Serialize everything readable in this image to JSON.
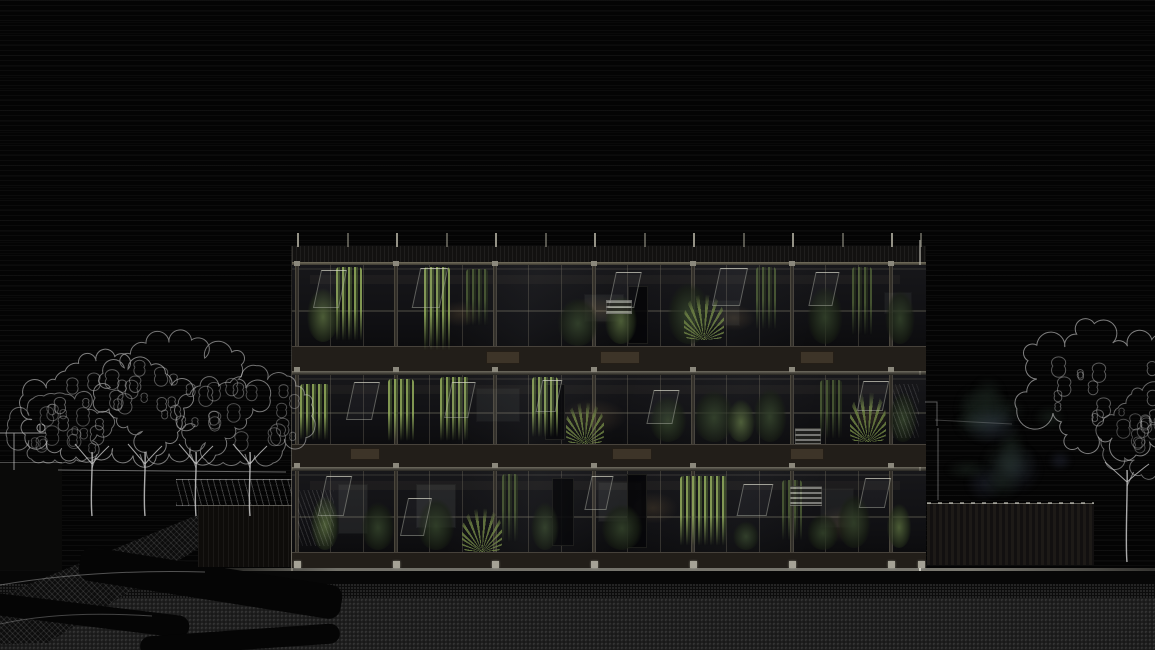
{
  "scene": {
    "type": "architectural-elevation-night-render",
    "description": "dark night elevation of a 3-storey glass building filled with plants, wireframe trees left and right, hatched ramp and stippled ground",
    "palette": {
      "sky": "#040404",
      "scanline": "rgba(255,255,255,0.03)",
      "frame_bright": "#a5a296",
      "frame_dark": "#26231e",
      "spandrel": "#221e19",
      "glass": "#141418",
      "vine_bright": "#8faa5c",
      "vine_mid": "#647c42",
      "foliage_dark": "#303e28",
      "foliage_mid": "#526439",
      "warm_light": "#b99258",
      "wireframe": "#c9c9c9",
      "fence": "#1b1816",
      "curb": "#969488",
      "ground": "#191919"
    },
    "building": {
      "floors": 3,
      "bay_columns_x": [
        297,
        396,
        495,
        594,
        693,
        792,
        891
      ],
      "parapet_post_count": 14,
      "floor_bands": [
        {
          "glass_top": 34,
          "glass_h": 81,
          "spandrel_top": 115,
          "spandrel_h": 25,
          "transom": 79
        },
        {
          "glass_top": 144,
          "glass_h": 69,
          "spandrel_top": 213,
          "spandrel_h": 23,
          "transom": 181
        },
        {
          "glass_top": 240,
          "glass_h": 81,
          "spandrel_top": 321,
          "spandrel_h": 16,
          "transom": 285
        }
      ],
      "plants": [
        {
          "x": 336,
          "y": 267,
          "w": 26,
          "h": 76,
          "t": "vb"
        },
        {
          "x": 306,
          "y": 286,
          "w": 34,
          "h": 56,
          "t": "pm"
        },
        {
          "x": 424,
          "y": 267,
          "w": 26,
          "h": 86,
          "t": "vb"
        },
        {
          "x": 466,
          "y": 269,
          "w": 22,
          "h": 60,
          "t": "vm"
        },
        {
          "x": 556,
          "y": 296,
          "w": 44,
          "h": 50,
          "t": "pd"
        },
        {
          "x": 604,
          "y": 294,
          "w": 34,
          "h": 50,
          "t": "pm"
        },
        {
          "x": 666,
          "y": 280,
          "w": 46,
          "h": 64,
          "t": "pd"
        },
        {
          "x": 684,
          "y": 294,
          "w": 40,
          "h": 46,
          "t": "pp"
        },
        {
          "x": 756,
          "y": 267,
          "w": 20,
          "h": 66,
          "t": "vm"
        },
        {
          "x": 806,
          "y": 284,
          "w": 38,
          "h": 60,
          "t": "pd"
        },
        {
          "x": 852,
          "y": 267,
          "w": 20,
          "h": 72,
          "t": "vm"
        },
        {
          "x": 884,
          "y": 288,
          "w": 32,
          "h": 56,
          "t": "pd"
        },
        {
          "x": 300,
          "y": 384,
          "w": 30,
          "h": 58,
          "t": "vb"
        },
        {
          "x": 388,
          "y": 379,
          "w": 26,
          "h": 64,
          "t": "vb"
        },
        {
          "x": 440,
          "y": 377,
          "w": 30,
          "h": 66,
          "t": "vb"
        },
        {
          "x": 532,
          "y": 377,
          "w": 26,
          "h": 62,
          "t": "vb"
        },
        {
          "x": 566,
          "y": 402,
          "w": 38,
          "h": 42,
          "t": "pp"
        },
        {
          "x": 648,
          "y": 394,
          "w": 40,
          "h": 48,
          "t": "pd"
        },
        {
          "x": 692,
          "y": 388,
          "w": 44,
          "h": 54,
          "t": "pd"
        },
        {
          "x": 726,
          "y": 398,
          "w": 30,
          "h": 44,
          "t": "pm"
        },
        {
          "x": 752,
          "y": 386,
          "w": 36,
          "h": 56,
          "t": "pd"
        },
        {
          "x": 820,
          "y": 380,
          "w": 22,
          "h": 62,
          "t": "vm"
        },
        {
          "x": 850,
          "y": 392,
          "w": 36,
          "h": 50,
          "t": "pp"
        },
        {
          "x": 888,
          "y": 390,
          "w": 30,
          "h": 52,
          "t": "pd"
        },
        {
          "x": 310,
          "y": 494,
          "w": 30,
          "h": 56,
          "t": "pm"
        },
        {
          "x": 360,
          "y": 500,
          "w": 36,
          "h": 50,
          "t": "pd"
        },
        {
          "x": 416,
          "y": 496,
          "w": 40,
          "h": 54,
          "t": "pd"
        },
        {
          "x": 462,
          "y": 508,
          "w": 40,
          "h": 44,
          "t": "pp"
        },
        {
          "x": 502,
          "y": 474,
          "w": 16,
          "h": 72,
          "t": "vm"
        },
        {
          "x": 530,
          "y": 500,
          "w": 30,
          "h": 50,
          "t": "pd"
        },
        {
          "x": 600,
          "y": 502,
          "w": 44,
          "h": 48,
          "t": "pd"
        },
        {
          "x": 680,
          "y": 476,
          "w": 48,
          "h": 72,
          "t": "vb"
        },
        {
          "x": 732,
          "y": 520,
          "w": 28,
          "h": 30,
          "t": "pd"
        },
        {
          "x": 782,
          "y": 480,
          "w": 20,
          "h": 64,
          "t": "vm"
        },
        {
          "x": 806,
          "y": 512,
          "w": 34,
          "h": 38,
          "t": "pd"
        },
        {
          "x": 836,
          "y": 492,
          "w": 36,
          "h": 56,
          "t": "pd"
        },
        {
          "x": 886,
          "y": 502,
          "w": 26,
          "h": 46,
          "t": "pm"
        }
      ],
      "open_windows": [
        {
          "x": 317,
          "y": 270,
          "w": 26,
          "h": 38
        },
        {
          "x": 416,
          "y": 268,
          "w": 28,
          "h": 40
        },
        {
          "x": 612,
          "y": 272,
          "w": 26,
          "h": 36
        },
        {
          "x": 716,
          "y": 268,
          "w": 28,
          "h": 38
        },
        {
          "x": 812,
          "y": 272,
          "w": 24,
          "h": 34
        },
        {
          "x": 350,
          "y": 382,
          "w": 26,
          "h": 38
        },
        {
          "x": 448,
          "y": 382,
          "w": 24,
          "h": 36
        },
        {
          "x": 539,
          "y": 380,
          "w": 20,
          "h": 32
        },
        {
          "x": 650,
          "y": 390,
          "w": 26,
          "h": 34
        },
        {
          "x": 860,
          "y": 381,
          "w": 26,
          "h": 30
        },
        {
          "x": 322,
          "y": 476,
          "w": 26,
          "h": 40
        },
        {
          "x": 404,
          "y": 498,
          "w": 24,
          "h": 38
        },
        {
          "x": 588,
          "y": 476,
          "w": 22,
          "h": 34
        },
        {
          "x": 740,
          "y": 484,
          "w": 30,
          "h": 32
        },
        {
          "x": 862,
          "y": 478,
          "w": 26,
          "h": 30
        }
      ],
      "blinds": [
        {
          "x": 795,
          "y": 428,
          "w": 26,
          "h": 16
        },
        {
          "x": 790,
          "y": 486,
          "w": 32,
          "h": 20
        },
        {
          "x": 606,
          "y": 300,
          "w": 26,
          "h": 14
        }
      ],
      "interior_panels": [
        {
          "x": 416,
          "y": 484,
          "w": 40,
          "h": 44,
          "o": 0.16
        },
        {
          "x": 598,
          "y": 482,
          "w": 44,
          "h": 40,
          "o": 0.14
        },
        {
          "x": 820,
          "y": 488,
          "w": 34,
          "h": 40,
          "o": 0.1
        },
        {
          "x": 476,
          "y": 388,
          "w": 44,
          "h": 34,
          "o": 0.1
        },
        {
          "x": 584,
          "y": 294,
          "w": 40,
          "h": 28,
          "o": 0.12
        },
        {
          "x": 700,
          "y": 300,
          "w": 40,
          "h": 26,
          "o": 0.1
        },
        {
          "x": 884,
          "y": 292,
          "w": 28,
          "h": 22,
          "o": 0.1
        },
        {
          "x": 338,
          "y": 484,
          "w": 30,
          "h": 50,
          "o": 0.14
        }
      ],
      "dark_doors": [
        {
          "x": 552,
          "y": 478,
          "w": 22,
          "h": 68
        },
        {
          "x": 627,
          "y": 474,
          "w": 20,
          "h": 74
        },
        {
          "x": 545,
          "y": 384,
          "w": 20,
          "h": 56
        },
        {
          "x": 628,
          "y": 286,
          "w": 20,
          "h": 58
        }
      ],
      "warm_lights": [
        {
          "x": 545,
          "y": 392,
          "w": 95,
          "h": 50
        },
        {
          "x": 560,
          "y": 290,
          "w": 80,
          "h": 40
        },
        {
          "x": 430,
          "y": 296,
          "w": 60,
          "h": 36
        },
        {
          "x": 618,
          "y": 486,
          "w": 70,
          "h": 44
        },
        {
          "x": 704,
          "y": 300,
          "w": 60,
          "h": 36
        },
        {
          "x": 806,
          "y": 498,
          "w": 74,
          "h": 52
        },
        {
          "x": 840,
          "y": 398,
          "w": 60,
          "h": 40
        }
      ],
      "reflections": [
        {
          "x": 298,
          "y": 490,
          "w": 36,
          "h": 56
        },
        {
          "x": 893,
          "y": 384,
          "w": 26,
          "h": 54
        }
      ],
      "spandrel_lit_panels": [
        {
          "x": 600,
          "y": 351,
          "w": 40,
          "h": 13
        },
        {
          "x": 486,
          "y": 351,
          "w": 34,
          "h": 13
        },
        {
          "x": 800,
          "y": 351,
          "w": 34,
          "h": 13
        },
        {
          "x": 612,
          "y": 448,
          "w": 40,
          "h": 12
        },
        {
          "x": 790,
          "y": 448,
          "w": 34,
          "h": 12
        },
        {
          "x": 350,
          "y": 448,
          "w": 30,
          "h": 12
        }
      ]
    },
    "left_trees": {
      "style": "white-wireframe",
      "canopy": {
        "x": 30,
        "y": 352,
        "w": 256,
        "h": 118
      },
      "trunks_x": [
        92,
        145,
        196,
        250
      ],
      "trunk_bottom_y": 516,
      "base_line_y": 470
    },
    "street_lamp": {
      "x": 14,
      "y": 432
    },
    "right_wire_tree": {
      "style": "white-wireframe",
      "canopy": {
        "x": 1038,
        "y": 330,
        "w": 120,
        "h": 150
      },
      "trunk_x": 1127,
      "trunk_bottom_y": 562
    },
    "right_dark_tree": {
      "style": "dark-foliage",
      "x": 930,
      "y": 365,
      "w": 150,
      "h": 145,
      "hue_hint": "#232d33 with faint blue-violet"
    },
    "fence_right": {
      "x": 927,
      "y": 503,
      "w": 167,
      "h": 62
    },
    "ramp_left": {
      "texture": "crosshatch",
      "from": [
        200,
        515
      ],
      "to": [
        0,
        640
      ]
    },
    "ground": {
      "curb_y": 568,
      "fine_stipple_band": [
        584,
        598
      ],
      "coarse_stipple_band": [
        598,
        650
      ]
    }
  }
}
